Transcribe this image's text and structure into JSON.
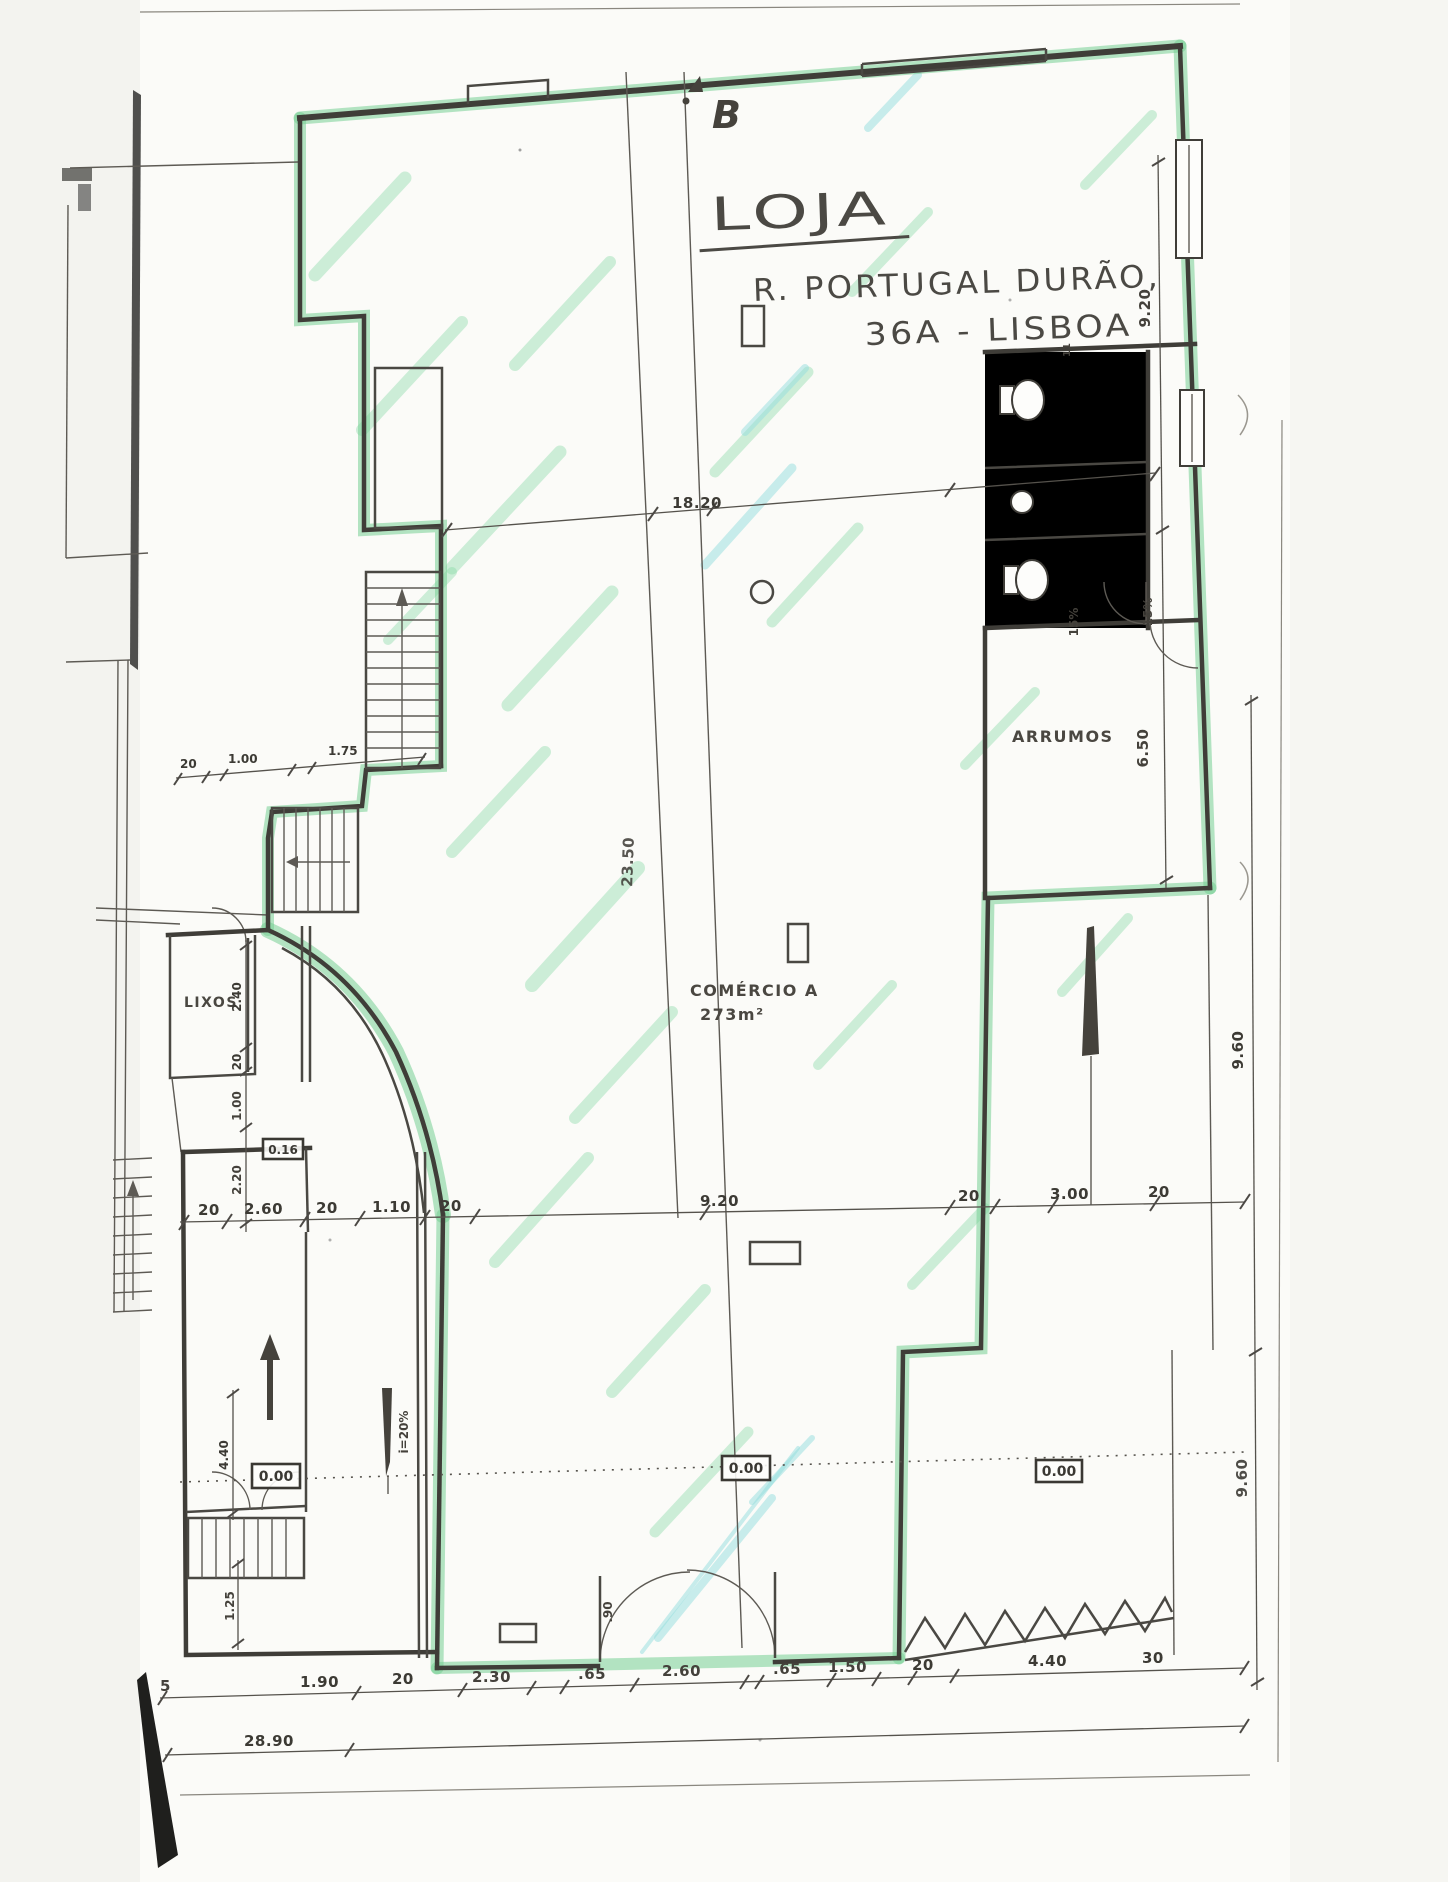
{
  "title": {
    "name": "LOJA",
    "address_line1": "R. PORTUGAL DURÃO,",
    "address_line2": "36A - LISBOA"
  },
  "section_marker": "B",
  "rooms": {
    "main": {
      "name": "COMÉRCIO A",
      "area": "273m²"
    },
    "storage": "ARRUMOS",
    "trash": "LIXOS"
  },
  "levels": {
    "left": "0.00",
    "center": "0.00",
    "right": "0.00",
    "mezz": "0.16"
  },
  "slopes": {
    "ramp": "i=20%",
    "wc_1": "15%",
    "wc_2": "15%"
  },
  "dimensions": {
    "top": "18.20",
    "center_vertical": "23.50",
    "right_inner": [
      "9.20",
      "6.50"
    ],
    "right_outer": [
      "9.60",
      "9.60"
    ],
    "mid_row": [
      "20",
      "2.60",
      "20",
      "1.10",
      "20",
      "9.20",
      "20",
      "3.00",
      "20"
    ],
    "bottom_row": [
      "5",
      "1.90",
      "20",
      "2.30",
      ".65",
      "2.60",
      ".65",
      "1.50",
      "20",
      "4.40",
      "30"
    ],
    "total_width": "28.90",
    "left_upper_row": [
      "20",
      "1.00",
      "1.75"
    ],
    "left_column": [
      "2.40",
      "20",
      "1.00",
      "2.20",
      "4.40",
      "1.25"
    ],
    "door": ".90",
    "wc_wall": "11"
  },
  "colors": {
    "highlight_green": "#76d094",
    "highlight_cyan": "#94dede",
    "ink": "#3f3d38"
  }
}
